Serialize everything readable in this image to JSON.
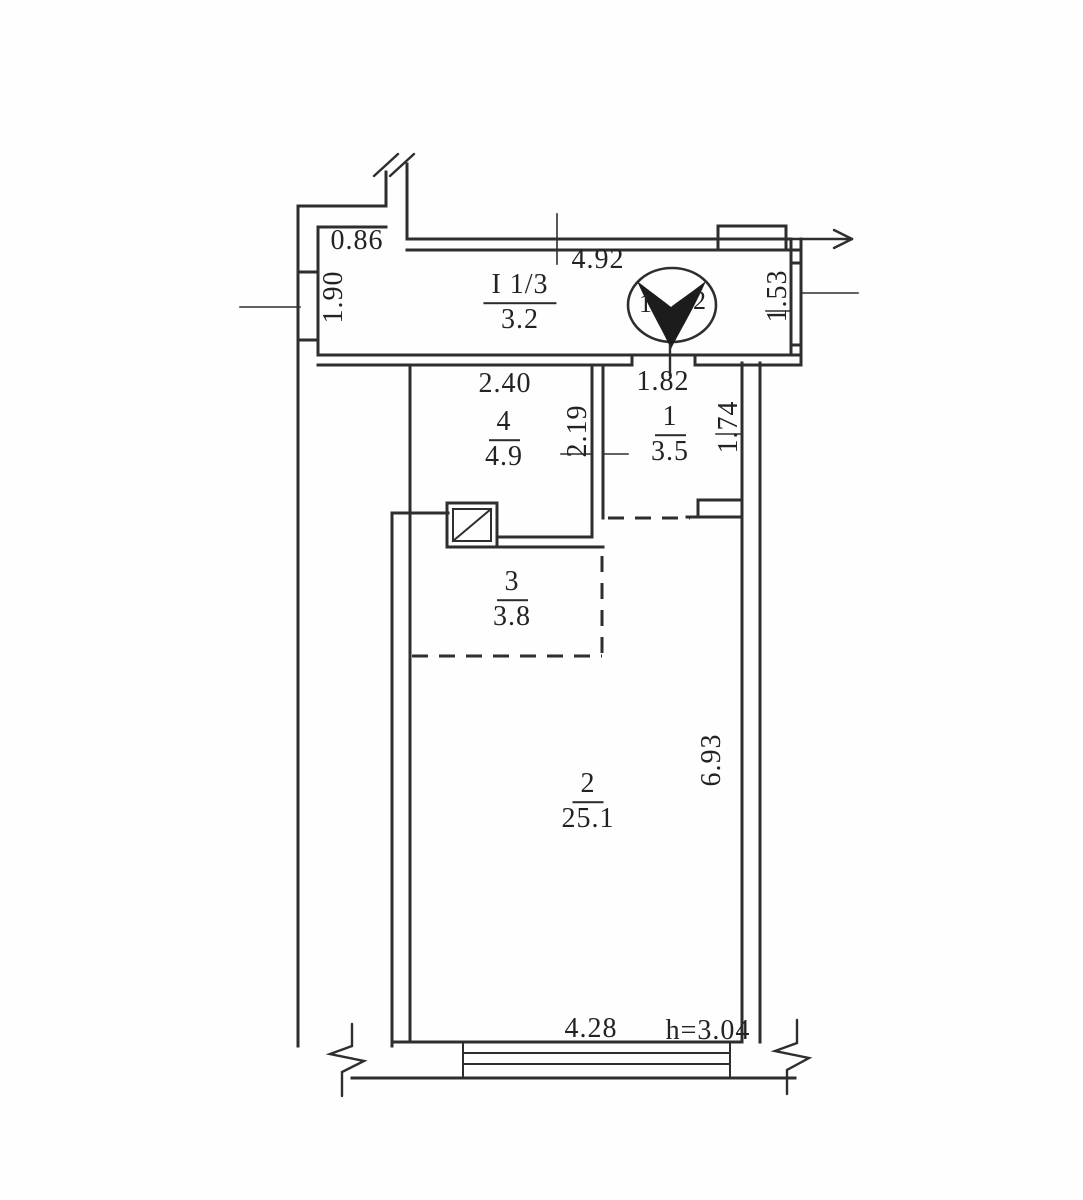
{
  "plan": {
    "rooms": [
      {
        "number": "I 1/3",
        "area": "3.2"
      },
      {
        "number": "4",
        "area": "4.9"
      },
      {
        "number": "1",
        "area": "3.5"
      },
      {
        "number": "3",
        "area": "3.8"
      },
      {
        "number": "2",
        "area": "25.1"
      }
    ],
    "dimensions": {
      "niche_width": "0.86",
      "left_window": "1.90",
      "top_width": "4.92",
      "right_window": "1.53",
      "room4_width": "2.40",
      "room4_depth": "2.19",
      "room1_width": "1.82",
      "room1_depth": "1.74",
      "room2_depth": "6.93",
      "bottom_window": "4.28",
      "ceiling_height": "h=3.04"
    },
    "north_badge": {
      "left": "1",
      "right": "2"
    }
  }
}
